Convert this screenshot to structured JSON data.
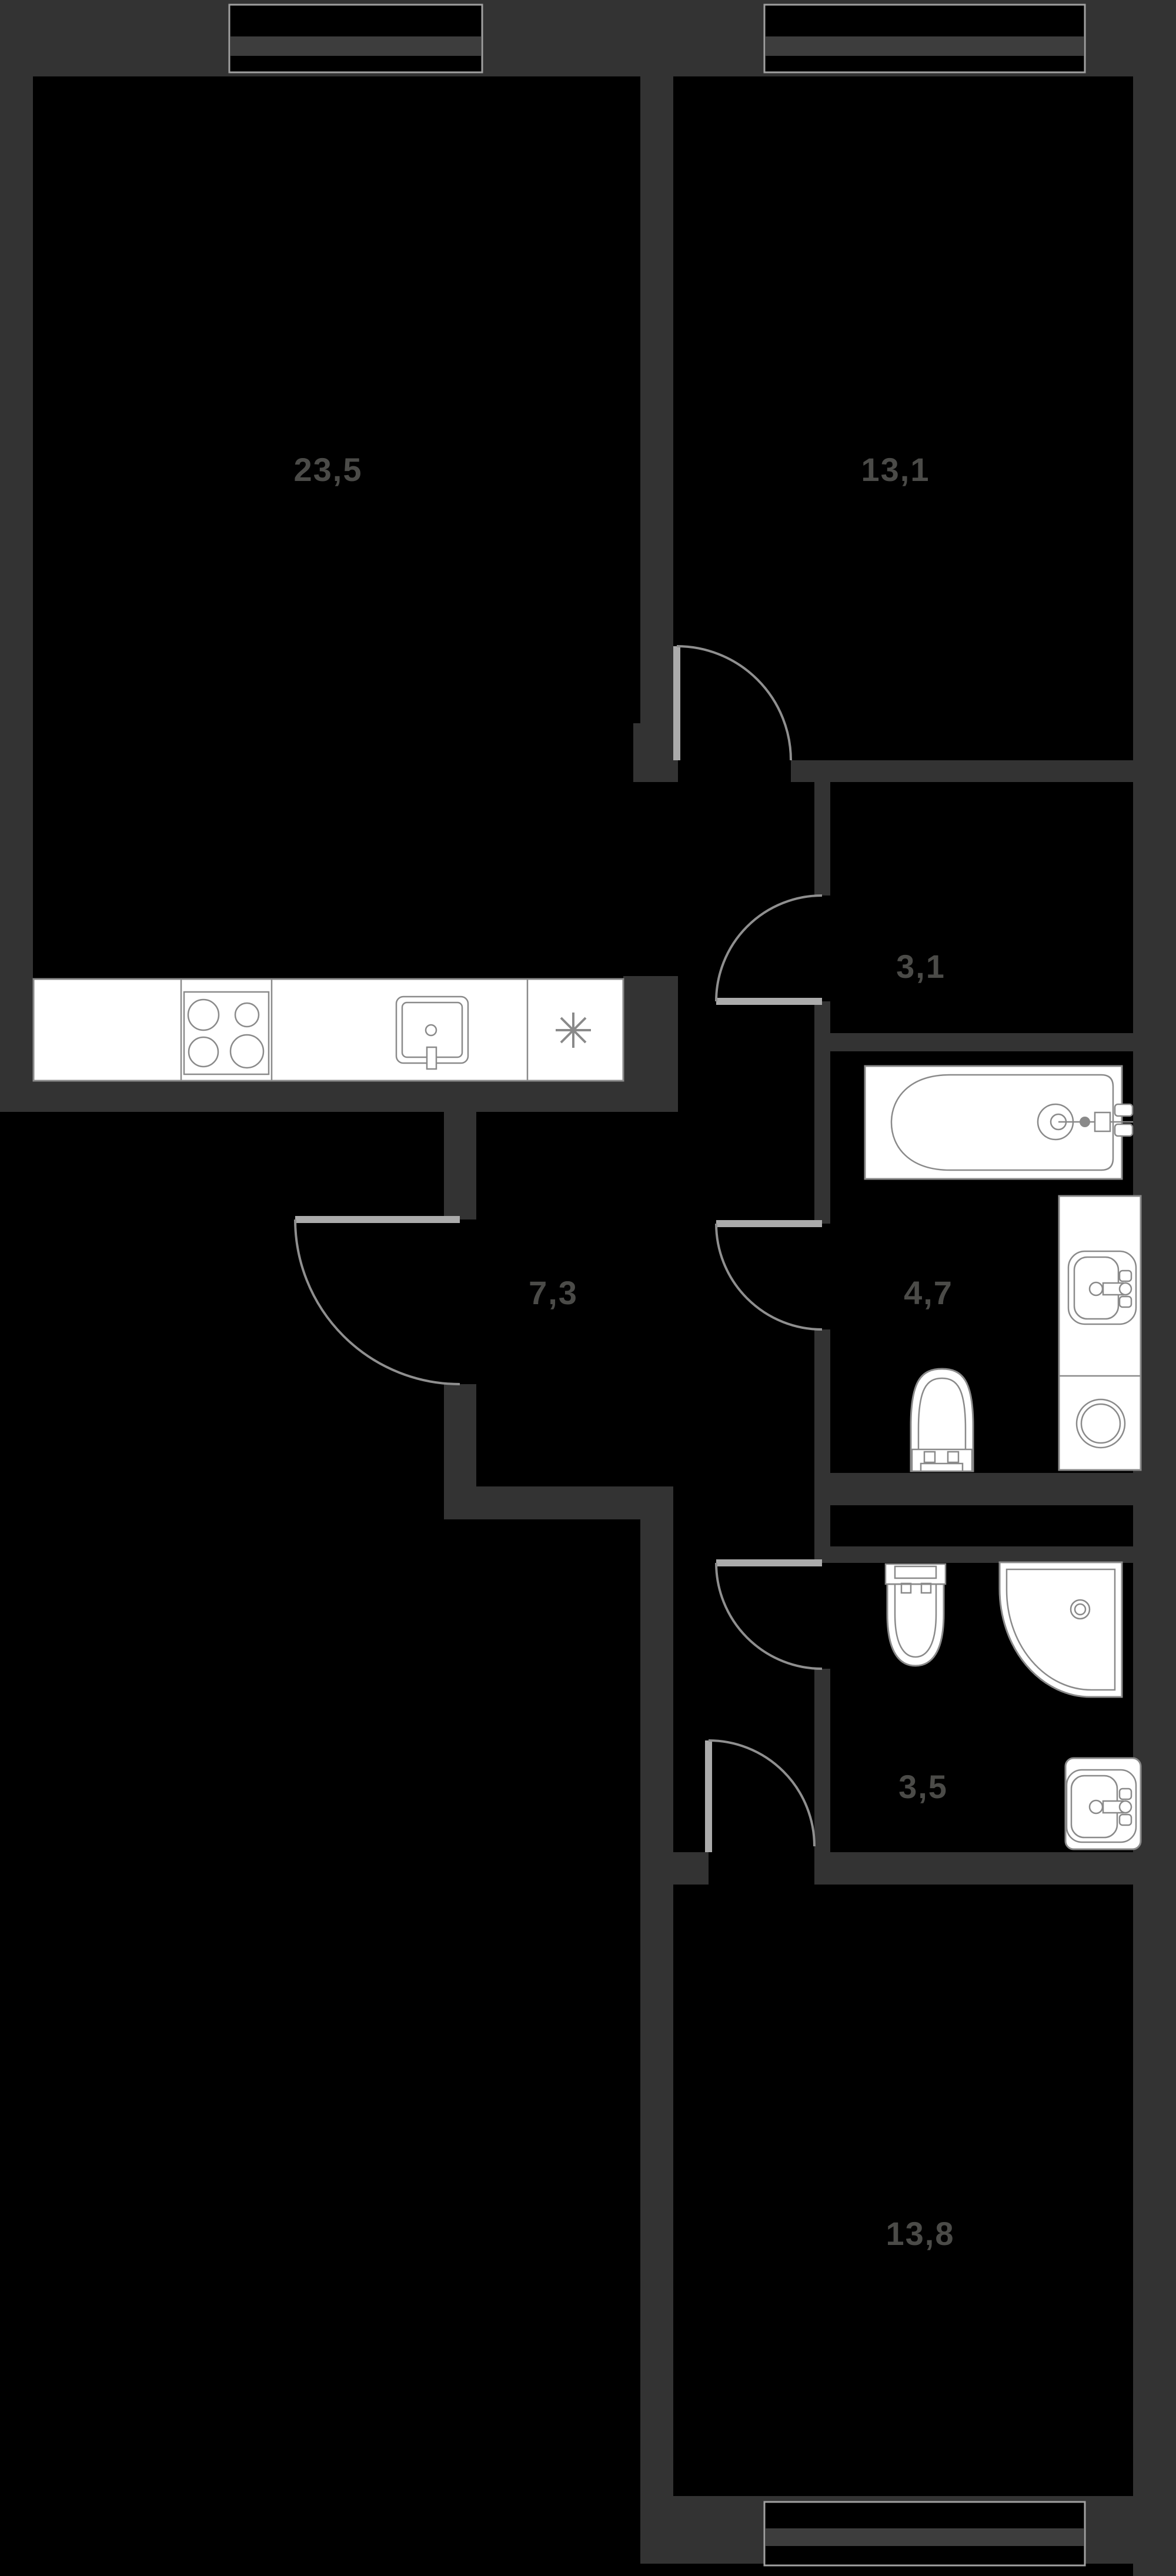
{
  "plan": {
    "type": "apartment-floor-plan",
    "theme": {
      "background": "#000000",
      "wall": "#333333",
      "fixture_fill": "#ffffff",
      "fixture_stroke": "#8a8a8a",
      "door": "#8f8f8f",
      "door_leaf": "#ababab",
      "label": "#4b4b48"
    },
    "rooms": [
      {
        "name": "living-room-kitchen",
        "area": "23,5"
      },
      {
        "name": "bedroom-upper",
        "area": "13,1"
      },
      {
        "name": "hall",
        "area": "3,1"
      },
      {
        "name": "corridor",
        "area": "7,3"
      },
      {
        "name": "bathroom",
        "area": "4,7"
      },
      {
        "name": "wc",
        "area": "3,5"
      },
      {
        "name": "bedroom-lower",
        "area": "13,8"
      }
    ],
    "fixtures": [
      "kitchen-counter",
      "stove-4-burners",
      "kitchen-sink",
      "refrigerator-asterisk",
      "bathtub",
      "washbasin",
      "washing-machine",
      "toilet",
      "toilet-2",
      "shower-tray",
      "washbasin-2"
    ]
  }
}
